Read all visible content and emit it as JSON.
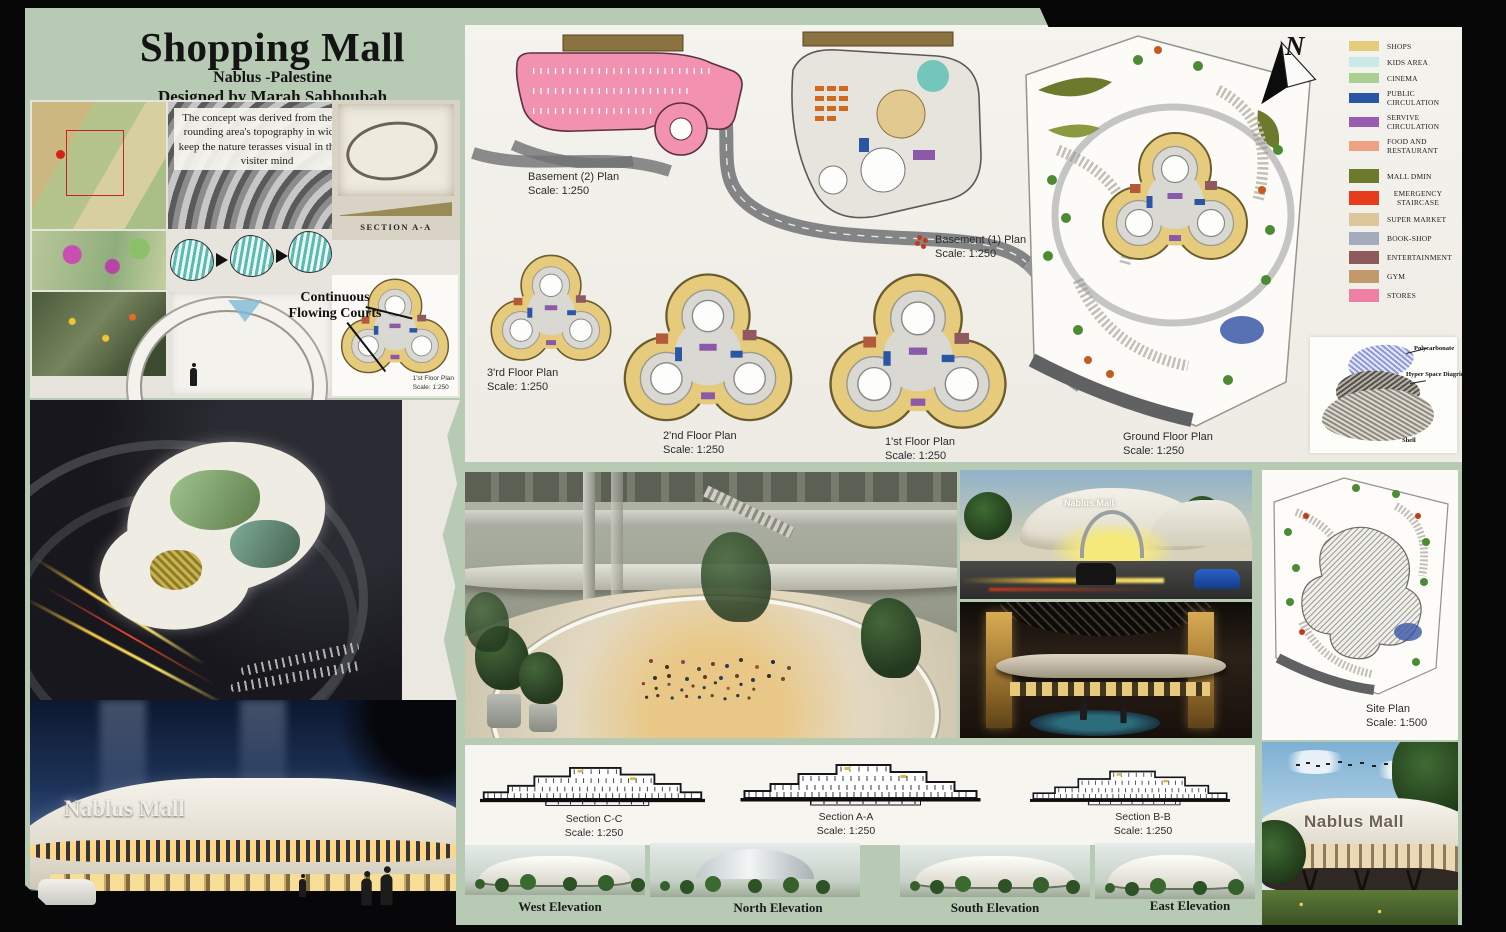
{
  "header": {
    "title": "Shopping Mall",
    "subtitle": "Nablus -Palestine",
    "designer": "Designed by Marah Sabboubah"
  },
  "concept": {
    "text": "The concept was derived from the sur- rounding area's topography in wich to keep the nature terasses visual in the the visiter mind",
    "sketch_caption": "SECTION A-A",
    "annotation_line1": "Continuous",
    "annotation_line2": "Flowing Courts"
  },
  "plans": {
    "mini_first": {
      "name": "1'st Floor Plan",
      "scale": "Scale: 1:250"
    },
    "basement2": {
      "name": "Basement (2) Plan",
      "scale": "Scale: 1:250"
    },
    "basement1": {
      "name": "Basement (1) Plan",
      "scale": "Scale: 1:250"
    },
    "third": {
      "name": "3'rd Floor Plan",
      "scale": "Scale: 1:250"
    },
    "second": {
      "name": "2'nd Floor Plan",
      "scale": "Scale: 1:250"
    },
    "first": {
      "name": "1'st Floor Plan",
      "scale": "Scale: 1:250"
    },
    "ground": {
      "name": "Ground Floor Plan",
      "scale": "Scale: 1:250"
    },
    "site": {
      "name": "Site Plan",
      "scale": "Scale: 1:500"
    }
  },
  "compass": {
    "label": "N"
  },
  "legend": {
    "items": [
      {
        "label": "SHOPS",
        "color": "#e7cb7c"
      },
      {
        "label": "KIDS AREA",
        "color": "#c8e9e5"
      },
      {
        "label": "CINEMA",
        "color": "#a9cf92"
      },
      {
        "label": "PUBLIC CIRCULATION",
        "color": "#2b55a5"
      },
      {
        "label": "SERVIVE CIRCULATION",
        "color": "#9a5cb0"
      },
      {
        "label": "FOOD AND RESTAURANT",
        "color": "#efa184"
      },
      {
        "label": "MALL DMIN",
        "color": "#6d7a2d"
      },
      {
        "label": "EMERGENCY STAIRCASE",
        "color": "#e83c1c"
      },
      {
        "label": "SUPER MARKET",
        "color": "#dcc79a"
      },
      {
        "label": "BOOK-SHOP",
        "color": "#a4abbc"
      },
      {
        "label": "ENTERTAINMENT",
        "color": "#8e5a5e"
      },
      {
        "label": "GYM",
        "color": "#c2996a"
      },
      {
        "label": "STORES",
        "color": "#ef7fa4"
      }
    ]
  },
  "materials": {
    "items": [
      "Polycarbonate",
      "Hyper Space Diagrid",
      "Shell"
    ]
  },
  "sections": [
    {
      "name": "Section C-C",
      "scale": "Scale: 1:250"
    },
    {
      "name": "Section A-A",
      "scale": "Scale: 1:250"
    },
    {
      "name": "Section B-B",
      "scale": "Scale: 1:250"
    }
  ],
  "elevations": [
    "West Elevation",
    "North Elevation",
    "South Elevation",
    "East Elevation"
  ],
  "signs": {
    "mall_name": "Nablus Mall"
  }
}
